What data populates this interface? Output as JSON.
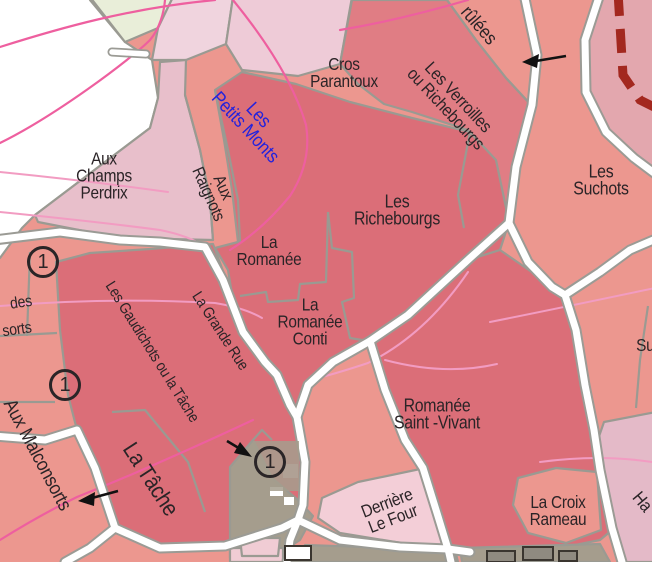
{
  "map": {
    "title": "Vosne-Romanée vineyard map section",
    "labels": {
      "brulees": "rûlées",
      "cros_parantoux": "Cros\nParantoux",
      "petits_monts": "Les\nPetits Monts",
      "verroilles": "Les Verroilles\nou Richebourgs",
      "champs_perdrix": "Aux\nChamps\nPerdrix",
      "raignots": "Aux\nRaignots",
      "richebourgs": "Les\nRichebourgs",
      "suchots": "Les\nSuchots",
      "suchots_2": "Les\nSuchots",
      "la_romanee": "La\nRomanée",
      "romanee_conti": "La\nRomanée\nConti",
      "romanee_saint_vivant": "Romanée\nSaint -Vivant",
      "gaudichots": "Les Gaudichots ou la Tâche",
      "grande_rue": "La Grande Rue",
      "la_tache": "La Tâche",
      "malconsorts": "Aux Malconsorts",
      "des_partial": "des",
      "sorts_partial": "sorts",
      "croix_rameau": "La Croix\nRameau",
      "derriere_le_four": "Derrière\nLe Four",
      "hautes_partial": "Ha"
    },
    "markers": {
      "m1": "1",
      "m2": "1",
      "m3": "1"
    },
    "palette": {
      "salmon": "#ec978f",
      "dark_rose": "#db6e78",
      "rose_strip": "#e07d84",
      "pink_light": "#e8bfcb",
      "pink_pale": "#eecbd7",
      "pink_paler": "#f0d4de",
      "blush": "#f3ced7",
      "lavender_pink": "#e4bac8",
      "corner_pink": "#e3a7ae",
      "pale_green": "#e9eed9",
      "taupe_village": "#a59d8d",
      "road_casing": "#9b9b95",
      "boundary_gray": "#9a9a92",
      "contour_pink": "#ee5f9f",
      "contour_pink_light": "#f29cc2",
      "boundary_dashed_red": "#a3281f",
      "label_text": "#2b2427",
      "label_text_blue": "#2222dd"
    }
  }
}
